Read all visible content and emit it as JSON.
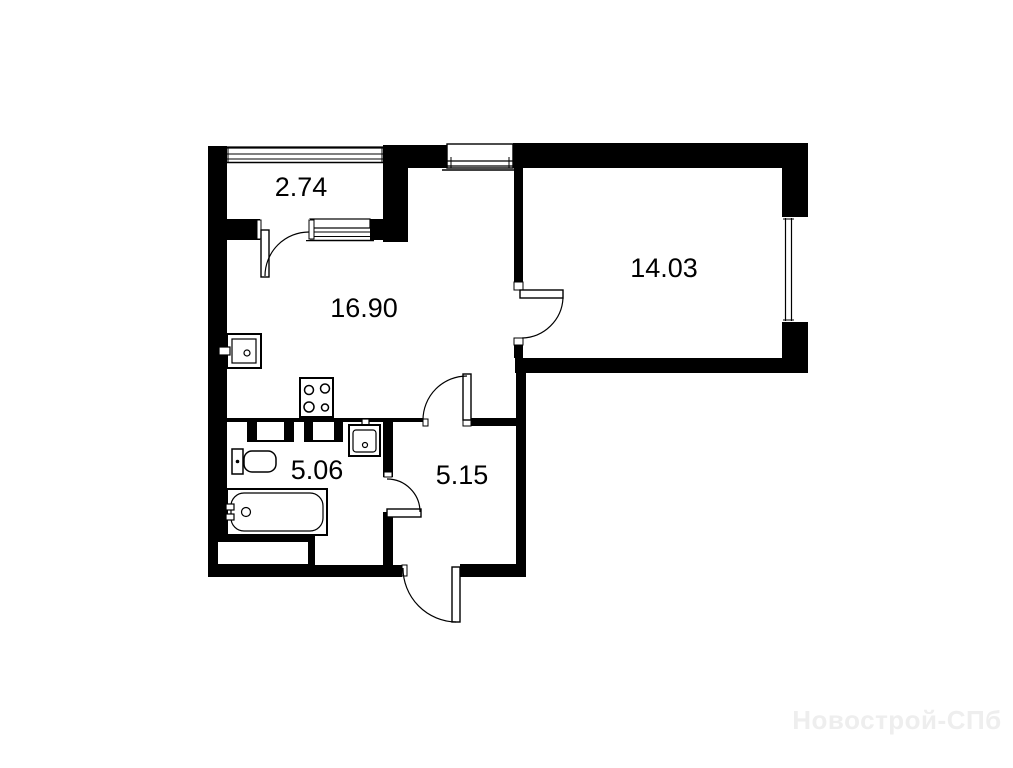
{
  "plan": {
    "type": "apartment-floor-plan",
    "rooms": [
      {
        "name": "balcony",
        "area": "2.74"
      },
      {
        "name": "living-kitchen",
        "area": "16.90"
      },
      {
        "name": "bedroom",
        "area": "14.03"
      },
      {
        "name": "bathroom",
        "area": "5.06"
      },
      {
        "name": "hallway",
        "area": "5.15"
      }
    ],
    "fixtures": [
      "kitchen-sink",
      "stove",
      "bathroom-sink",
      "toilet",
      "bathtub",
      "vent-duct"
    ],
    "watermark": "Новострой-СПб",
    "colors": {
      "walls": "#000000",
      "background": "#ffffff",
      "watermark": "#eeeeee"
    }
  }
}
